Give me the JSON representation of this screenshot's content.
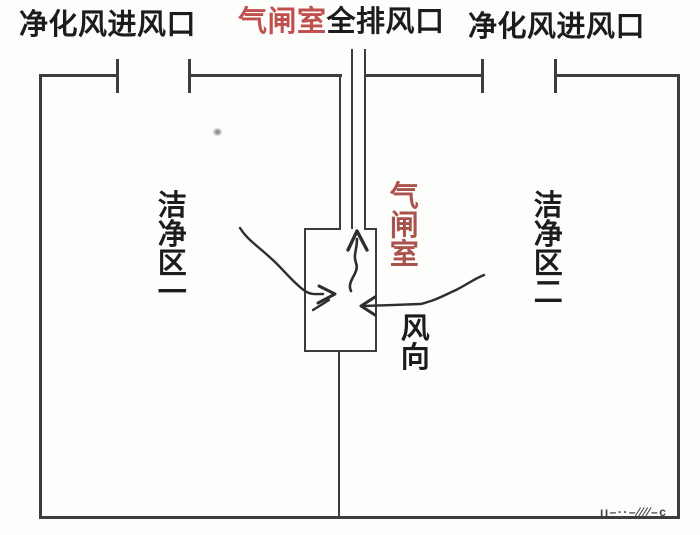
{
  "colors": {
    "line": "#3d3d3d",
    "text": "#1c1c1c",
    "title_red": "#c0504d",
    "vertical_red": "#a9534d",
    "watermark": "#3f3f3f"
  },
  "top_labels": {
    "left_inlet": "净化风进风口",
    "center_airlock_red": "气闸室",
    "center_exhaust": "全排风口",
    "right_inlet": "净化风进风口"
  },
  "zones": {
    "left": "洁净区一",
    "right": "洁净区二"
  },
  "airlock": {
    "label": "气闸室",
    "wind_direction": "风向"
  },
  "watermark_text": "ıı–··–⁄⁄⁄⁄–c"
}
